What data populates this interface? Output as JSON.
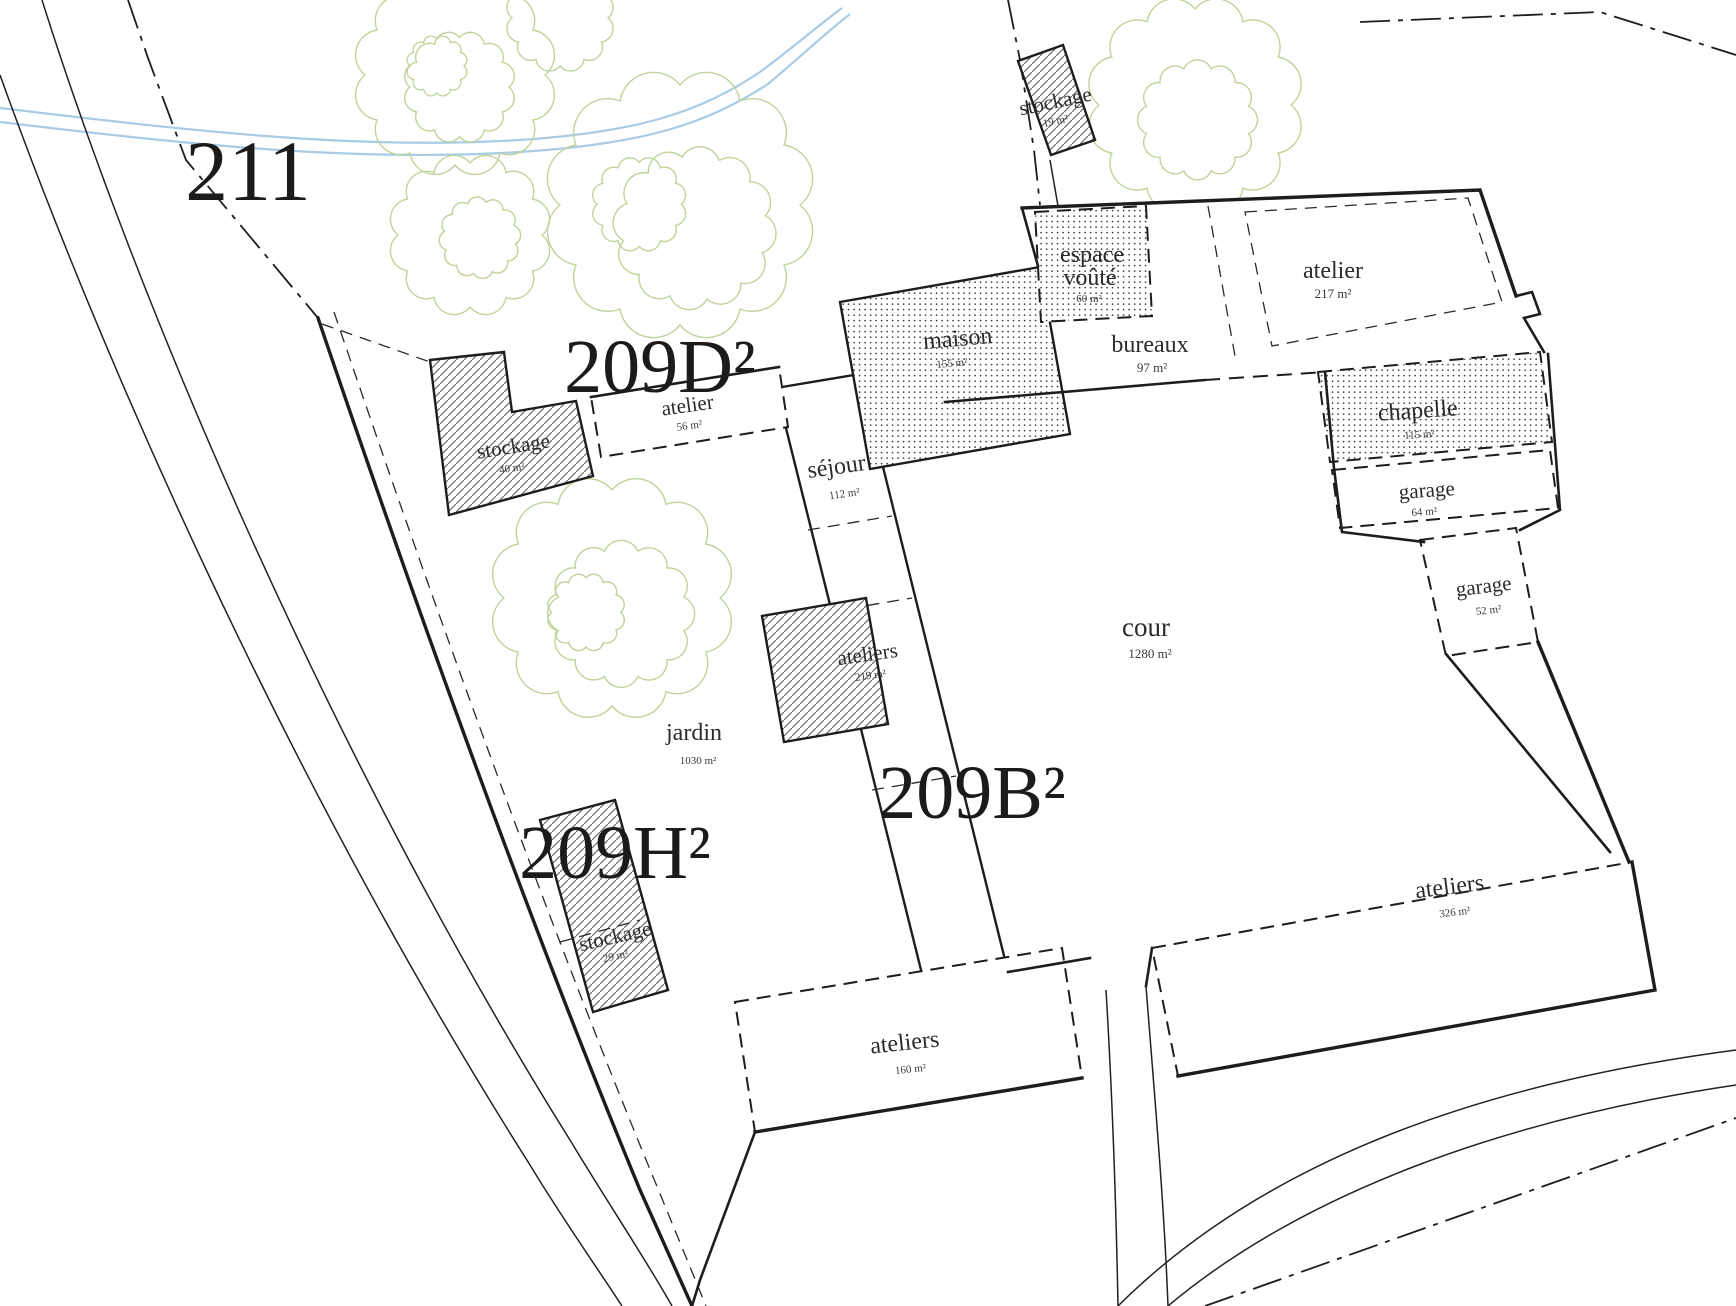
{
  "plan": {
    "colors": {
      "ink": "#1d1d1b",
      "foliage": "#bfd49b",
      "water": "#a8cbe6"
    },
    "parcels": {
      "p211": "211",
      "p209d": "209D²",
      "p209h": "209H²",
      "p209b": "209B²"
    },
    "rooms": {
      "stockage19": {
        "name": "stockage",
        "area": "19 m²"
      },
      "espace_voute": {
        "line1": "espace",
        "line2": "voûté",
        "area": "60 m²"
      },
      "atelier217": {
        "name": "atelier",
        "area": "217 m²"
      },
      "bureaux": {
        "name": "bureaux",
        "area": "97 m²"
      },
      "maison": {
        "name": "maison",
        "area": "155 m²"
      },
      "chapelle": {
        "name": "chapelle",
        "area": "115 m²"
      },
      "garage64": {
        "name": "garage",
        "area": "64 m²"
      },
      "garage52": {
        "name": "garage",
        "area": "52 m²"
      },
      "cour": {
        "name": "cour",
        "area": "1280 m²"
      },
      "atelier56": {
        "name": "atelier",
        "area": "56 m²"
      },
      "sejour": {
        "name": "séjour",
        "area": "112 m²"
      },
      "stockage40": {
        "name": "stockage",
        "area": "40 m²"
      },
      "ateliers219": {
        "name": "ateliers",
        "area": "219 m²"
      },
      "jardin": {
        "name": "jardin",
        "area": "1030 m²"
      },
      "stockage29": {
        "name": "stockage",
        "area": "29 m²"
      },
      "ateliers326": {
        "name": "ateliers",
        "area": "326 m²"
      },
      "ateliers160": {
        "name": "ateliers",
        "area": "160 m²"
      }
    }
  }
}
